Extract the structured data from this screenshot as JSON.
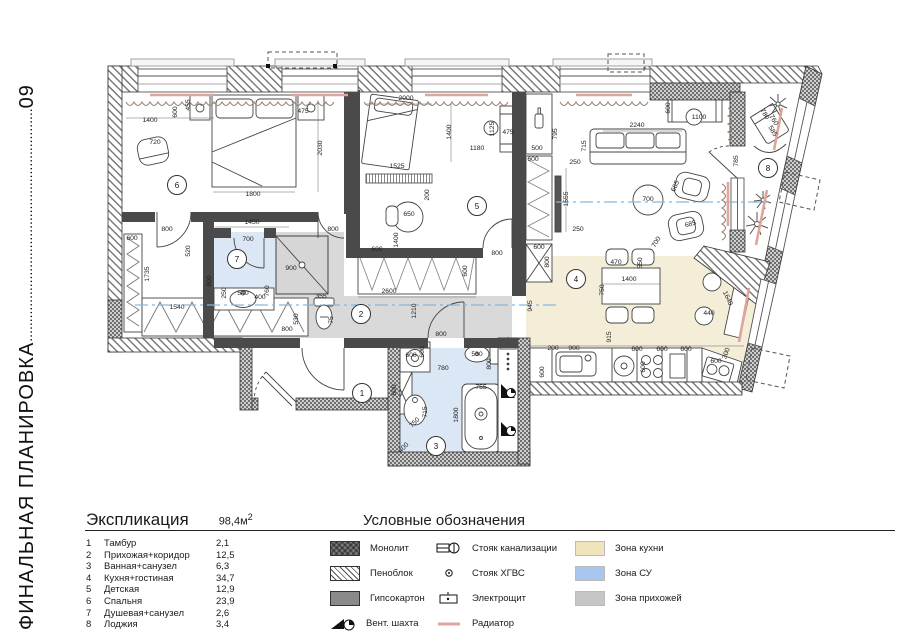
{
  "sidebar": {
    "title": "ФИНАЛЬНАЯ ПЛАНИРОВКА",
    "dots": "............................................................",
    "number": "09"
  },
  "explication": {
    "title": "Экспликация",
    "total_area": "98,4м",
    "total_area_sup": "2",
    "rows": [
      {
        "num": "1",
        "name": "Тамбур",
        "area": "2,1"
      },
      {
        "num": "2",
        "name": "Прихожая+коридор",
        "area": "12,5"
      },
      {
        "num": "3",
        "name": "Ванная+санузел",
        "area": "6,3"
      },
      {
        "num": "4",
        "name": "Кухня+гостиная",
        "area": "34,7"
      },
      {
        "num": "5",
        "name": "Детская",
        "area": "12,9"
      },
      {
        "num": "6",
        "name": "Спальня",
        "area": "23,9"
      },
      {
        "num": "7",
        "name": "Душевая+санузел",
        "area": "2,6"
      },
      {
        "num": "8",
        "name": "Лоджия",
        "area": "3,4"
      }
    ]
  },
  "legend": {
    "title": "Условные обозначения",
    "materials": [
      {
        "name": "Монолит",
        "swatch": "monolit"
      },
      {
        "name": "Пеноблок",
        "swatch": "penoblok"
      },
      {
        "name": "Гипсокартон",
        "swatch": "gypsum"
      },
      {
        "name": "Вент. шахта",
        "swatch": "vent"
      }
    ],
    "symbols": [
      {
        "name": "Стояк канализации",
        "icon": "sewer-riser"
      },
      {
        "name": "Стояк ХГВС",
        "icon": "water-riser"
      },
      {
        "name": "Электрощит",
        "icon": "electric-panel"
      },
      {
        "name": "Радиатор",
        "icon": "radiator"
      }
    ],
    "zones": [
      {
        "name": "Зона кухни",
        "color": "#f0e4bc"
      },
      {
        "name": "Зона СУ",
        "color": "#a9c7ee"
      },
      {
        "name": "Зона прихожей",
        "color": "#c6c6c6"
      }
    ]
  },
  "plan": {
    "zone_colors": {
      "kitchen": "#f4eed9",
      "bath": "#dbe7f5",
      "hall": "#d9d9d9"
    },
    "axis_color": "#86b7dd",
    "radiator_color": "#dfa49b",
    "room_numbers": [
      [
        "1",
        362,
        393
      ],
      [
        "2",
        361,
        314
      ],
      [
        "3",
        436,
        446
      ],
      [
        "4",
        576,
        279
      ],
      [
        "5",
        477,
        206
      ],
      [
        "6",
        177,
        185
      ],
      [
        "7",
        237,
        259
      ],
      [
        "8",
        768,
        168
      ]
    ],
    "dimensions": [
      [
        "1400",
        150,
        122,
        0
      ],
      [
        "600",
        177,
        112,
        -90
      ],
      [
        "455",
        190,
        105,
        -90
      ],
      [
        "475",
        303,
        113,
        0
      ],
      [
        "720",
        155,
        144,
        0
      ],
      [
        "2030",
        322,
        148,
        -90
      ],
      [
        "1800",
        253,
        196,
        0
      ],
      [
        "1450",
        252,
        224,
        0
      ],
      [
        "800",
        167,
        231,
        0
      ],
      [
        "800",
        333,
        231,
        0
      ],
      [
        "600",
        132,
        240,
        0
      ],
      [
        "1735",
        149,
        274,
        -90
      ],
      [
        "520",
        190,
        251,
        -90
      ],
      [
        "1540",
        177,
        309,
        0
      ],
      [
        "700",
        248,
        241,
        0
      ],
      [
        "250",
        226,
        293,
        -90
      ],
      [
        "540",
        243,
        295,
        0
      ],
      [
        "400",
        260,
        299,
        0
      ],
      [
        "800",
        211,
        281,
        -90
      ],
      [
        "900",
        291,
        270,
        0
      ],
      [
        "760",
        269,
        291,
        -90
      ],
      [
        "530",
        298,
        319,
        -90
      ],
      [
        "800",
        287,
        331,
        0
      ],
      [
        "355",
        321,
        298,
        0
      ],
      [
        "75",
        333,
        320,
        -90
      ],
      [
        "2000",
        406,
        100,
        0
      ],
      [
        "1400",
        451,
        132,
        -90
      ],
      [
        "1525",
        397,
        168,
        0
      ],
      [
        "1180",
        477,
        150,
        0
      ],
      [
        "1125",
        494,
        129,
        -90
      ],
      [
        "475",
        508,
        134,
        0
      ],
      [
        "200",
        429,
        195,
        -90
      ],
      [
        "650",
        409,
        216,
        0
      ],
      [
        "800",
        497,
        255,
        0
      ],
      [
        "1400",
        398,
        240,
        -90
      ],
      [
        "600",
        377,
        251,
        0
      ],
      [
        "2600",
        389,
        293,
        0
      ],
      [
        "600",
        467,
        271,
        -90
      ],
      [
        "1210",
        416,
        311,
        -90
      ],
      [
        "800",
        441,
        336,
        0
      ],
      [
        "500",
        537,
        150,
        0
      ],
      [
        "795",
        557,
        134,
        -90
      ],
      [
        "600",
        533,
        161,
        0
      ],
      [
        "600",
        539,
        249,
        0
      ],
      [
        "800",
        549,
        262,
        -90
      ],
      [
        "945",
        532,
        306,
        -90
      ],
      [
        "250",
        575,
        164,
        0
      ],
      [
        "1555",
        568,
        199,
        -90
      ],
      [
        "250",
        578,
        231,
        0
      ],
      [
        "715",
        586,
        146,
        -90
      ],
      [
        "2240",
        637,
        127,
        0
      ],
      [
        "600",
        670,
        108,
        -90
      ],
      [
        "1100",
        699,
        119,
        0
      ],
      [
        "700",
        648,
        201,
        0
      ],
      [
        "685",
        677,
        187,
        -65
      ],
      [
        "685",
        691,
        226,
        -15
      ],
      [
        "700",
        658,
        243,
        -60
      ],
      [
        "785",
        738,
        161,
        -90
      ],
      [
        "780",
        763,
        115,
        60
      ],
      [
        "760",
        772,
        121,
        60
      ],
      [
        "585",
        771,
        132,
        60
      ],
      [
        "470",
        616,
        264,
        0
      ],
      [
        "550",
        642,
        263,
        -90
      ],
      [
        "1400",
        629,
        281,
        0
      ],
      [
        "750",
        604,
        290,
        -90
      ],
      [
        "915",
        611,
        337,
        -90
      ],
      [
        "440",
        709,
        315,
        0
      ],
      [
        "1640",
        726,
        299,
        65
      ],
      [
        "200",
        553,
        350,
        0
      ],
      [
        "900",
        574,
        350,
        0
      ],
      [
        "600",
        637,
        351,
        0
      ],
      [
        "600",
        662,
        351,
        0
      ],
      [
        "600",
        686,
        351,
        0
      ],
      [
        "600",
        716,
        363,
        0
      ],
      [
        "300",
        728,
        354,
        -70
      ],
      [
        "600",
        544,
        372,
        -90
      ],
      [
        "600",
        645,
        367,
        -90
      ],
      [
        "600",
        411,
        357,
        0
      ],
      [
        "600",
        424,
        352,
        -90
      ],
      [
        "530",
        477,
        356,
        0
      ],
      [
        "800",
        491,
        364,
        -90
      ],
      [
        "780",
        443,
        370,
        0
      ],
      [
        "755",
        481,
        389,
        0
      ],
      [
        "1800",
        458,
        415,
        -90
      ],
      [
        "715",
        427,
        412,
        -90
      ],
      [
        "750",
        416,
        424,
        -45
      ],
      [
        "400",
        405,
        449,
        -45
      ],
      [
        "600",
        396,
        390,
        -90
      ]
    ]
  }
}
